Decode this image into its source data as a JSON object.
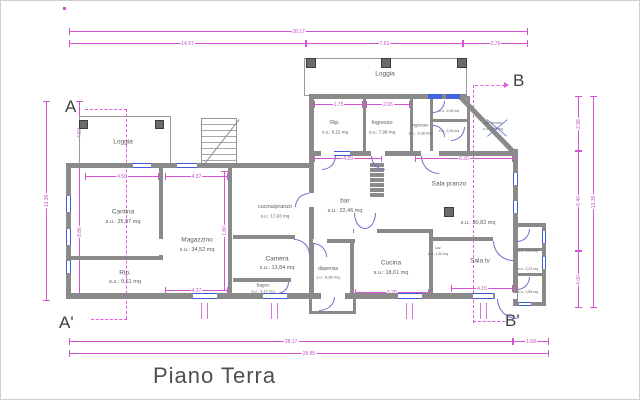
{
  "title": "Piano Terra",
  "markers": {
    "a": "A",
    "a_prime": "A'",
    "b": "B",
    "b_prime": "B'"
  },
  "rooms": {
    "loggia_left": {
      "name": "Loggia",
      "area": ""
    },
    "cantina": {
      "name": "Cantina",
      "area": "s.u.: 25,97 mq"
    },
    "rip_left": {
      "name": "Rip.",
      "area": "s.u.: 9,61 mq"
    },
    "magazzino": {
      "name": "Magazzino",
      "area": "s.u.: 34,52 mq"
    },
    "cucina_pranzo": {
      "name": "cucina/pranzo",
      "area": "s.u.: 17,03 mq"
    },
    "camera": {
      "name": "Camera",
      "area": "s.u.: 13,84 mq"
    },
    "bagno": {
      "name": "Bagno",
      "area": "s.u.: 3,17 mq"
    },
    "loggia_top": {
      "name": "Loggia",
      "area": ""
    },
    "rip_top": {
      "name": "Rip.",
      "area": "s.u.: 8,22 mq"
    },
    "ingresso": {
      "name": "Ingresso",
      "area": "s.u.: 7,98 mq"
    },
    "ingresso_small": {
      "name": "ingresso",
      "area": "s.u.: 3,08 mq"
    },
    "bar": {
      "name": "bar",
      "area": "s.u.: 22,46 mq"
    },
    "dispensa": {
      "name": "dispensa",
      "area": "s.u.: 6,60 mq"
    },
    "cucina": {
      "name": "Cucina",
      "area": "s.u.: 18,61 mq"
    },
    "sala_pranzo": {
      "name": "Sala pranzo",
      "area": "s.u.: 30,82 mq"
    },
    "sala_tv": {
      "name": "Sala tv",
      "area": ""
    },
    "lav": {
      "name": "Lav.",
      "area": "s.u.: 1,50 mq"
    },
    "wc_top_1": {
      "name": "wc",
      "area": "s.u.: 2,06 mq"
    },
    "wc_top_2": {
      "name": "wc",
      "area": "s.u.: 2,26 mq"
    },
    "loc_tecnico": {
      "name": "Loc. tecnico",
      "area": "s.u.: 3,05 mq"
    },
    "wc_right_1": {
      "name": "",
      "area": "s.u.: 2,22 mq"
    },
    "wc_right_2": {
      "name": "",
      "area": "s.u.: 2,22 mq"
    },
    "wc_right_3": {
      "name": "",
      "area": "s.u.: 1,89 mq"
    }
  },
  "dimensions": {
    "top_total": "28.17",
    "top_left": "14.57",
    "top_mid": "7.61",
    "top_right": "2.76",
    "bottom_main": "28.17",
    "bottom_right": "1.68",
    "bottom_total": "29.85",
    "left_total": "13.36",
    "left_top": "4.50",
    "left_bottom": "8.86",
    "right_total": "13.36",
    "right_top": "2.96",
    "right_mid": "6.40",
    "right_bottom": "4.00",
    "cantina_w": "4.50",
    "magazzino_w": "4.37",
    "magazzino_w2": "4.37",
    "magazzino_h": "7.80",
    "rip_w": "1.75",
    "ingresso_w": "2.65",
    "bar_w": "4.20",
    "hall_w": "6.30",
    "cucina_w": "5.25",
    "sala_tv_w": "4.15"
  }
}
